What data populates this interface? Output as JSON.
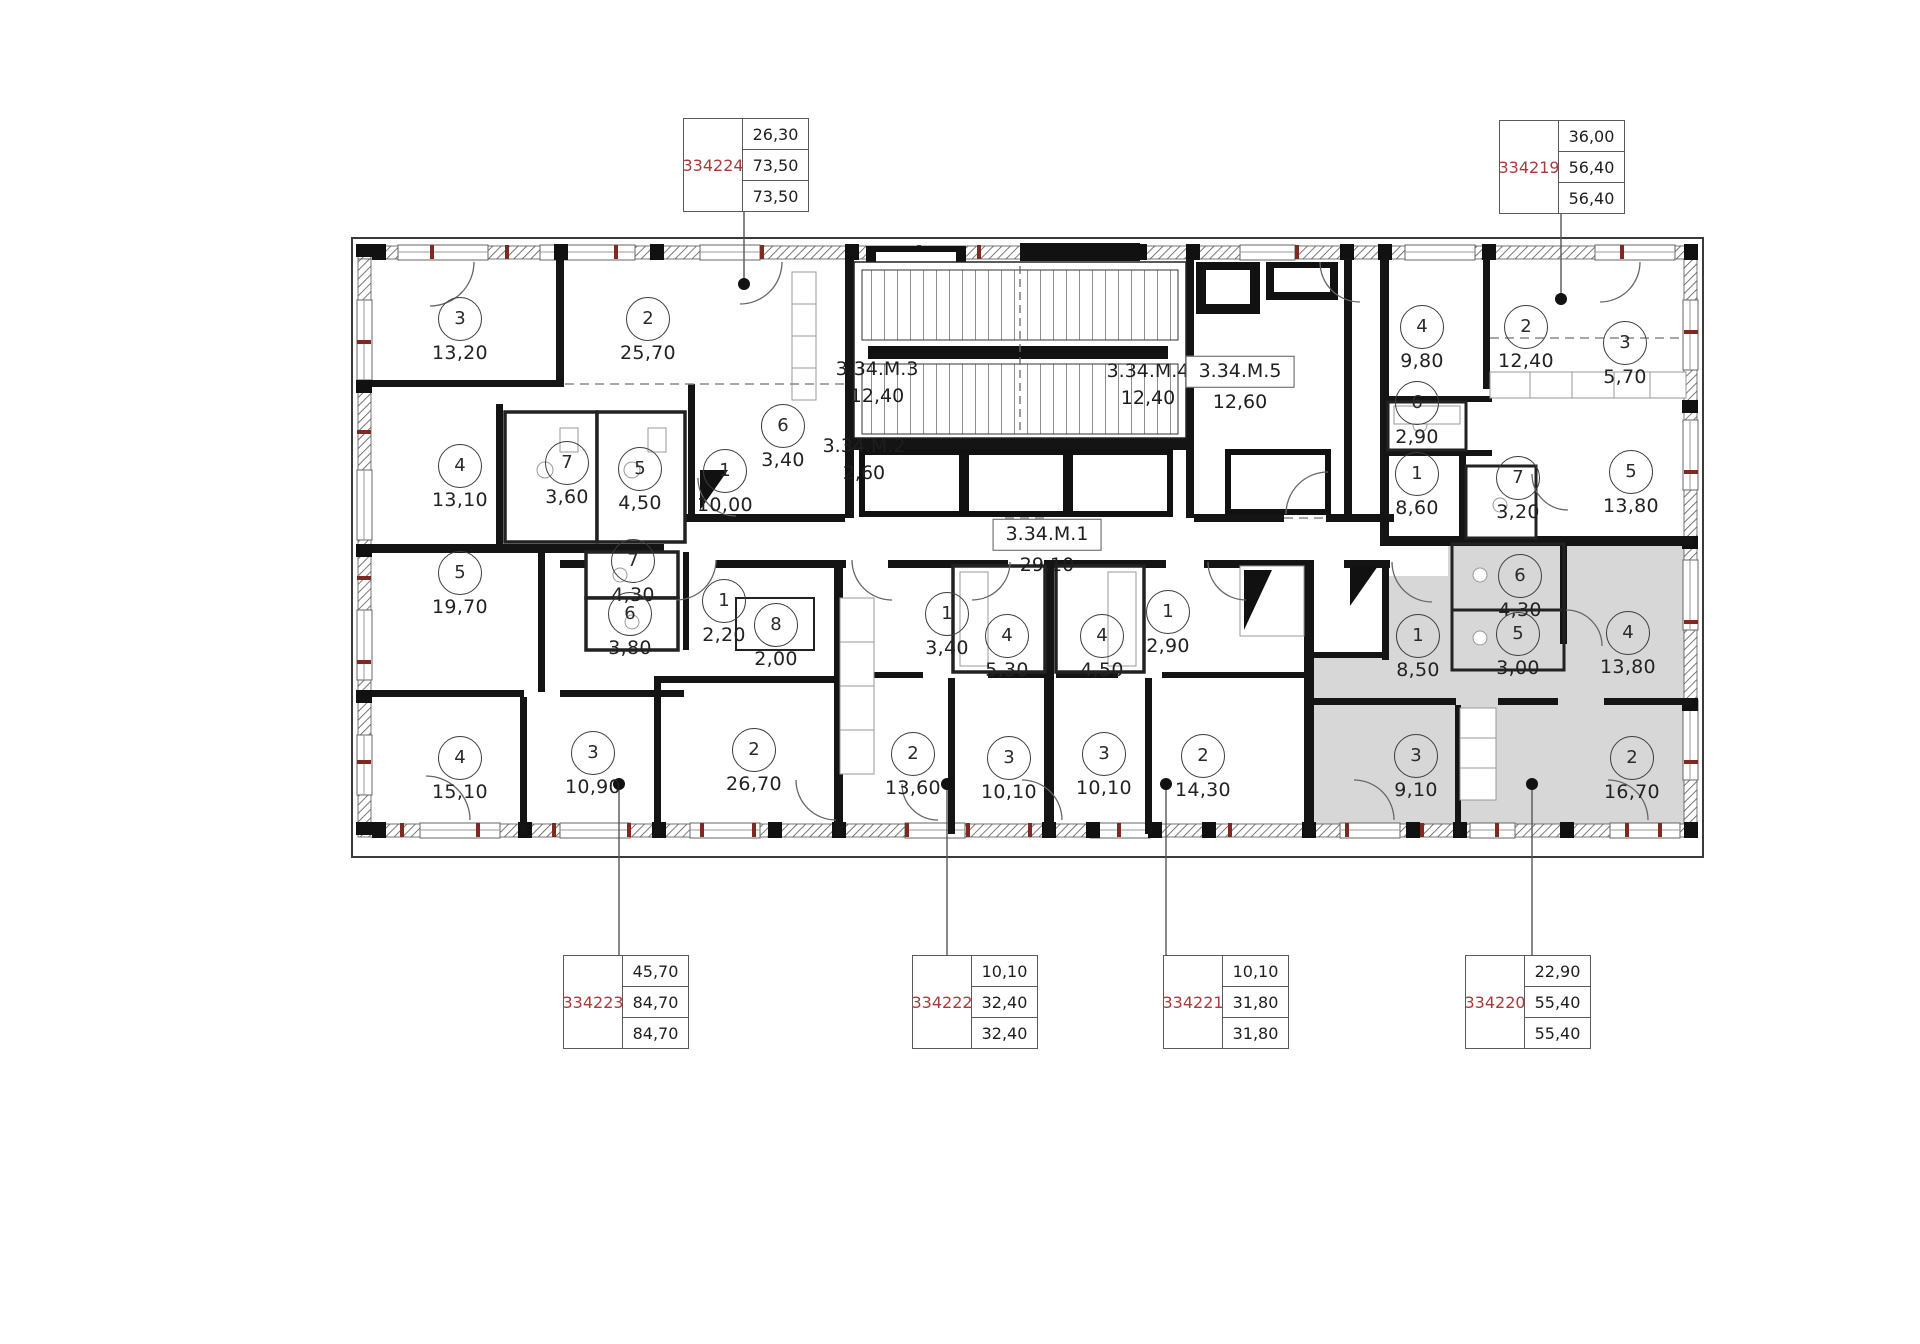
{
  "colors": {
    "highlight_fill": "#d7d7d7",
    "apartment_id_red": "#a93a3c",
    "wall_black": "#141414",
    "tick_dark_red": "#7e2a23"
  },
  "apartments": [
    {
      "id": "334224",
      "values": [
        "26,30",
        "73,50",
        "73,50"
      ],
      "box": {
        "x": 683,
        "y": 118
      },
      "dot": {
        "x": 744,
        "y": 284
      },
      "highlighted": false
    },
    {
      "id": "334219",
      "values": [
        "36,00",
        "56,40",
        "56,40"
      ],
      "box": {
        "x": 1499,
        "y": 120
      },
      "dot": {
        "x": 1561,
        "y": 299
      },
      "highlighted": false
    },
    {
      "id": "334223",
      "values": [
        "45,70",
        "84,70",
        "84,70"
      ],
      "box": {
        "x": 563,
        "y": 955
      },
      "dot": {
        "x": 619,
        "y": 784
      },
      "highlighted": false
    },
    {
      "id": "334222",
      "values": [
        "10,10",
        "32,40",
        "32,40"
      ],
      "box": {
        "x": 912,
        "y": 955
      },
      "dot": {
        "x": 947,
        "y": 784
      },
      "highlighted": false
    },
    {
      "id": "334221",
      "values": [
        "10,10",
        "31,80",
        "31,80"
      ],
      "box": {
        "x": 1163,
        "y": 955
      },
      "dot": {
        "x": 1166,
        "y": 784
      },
      "highlighted": false
    },
    {
      "id": "334220",
      "values": [
        "22,90",
        "55,40",
        "55,40"
      ],
      "box": {
        "x": 1465,
        "y": 955
      },
      "dot": {
        "x": 1532,
        "y": 784
      },
      "highlighted": true
    }
  ],
  "core_labels": [
    {
      "name": "3.34.M.1",
      "area": "29,10",
      "boxed": true,
      "x": 1047,
      "y": 548
    },
    {
      "name": "3.34.M.2",
      "area": "2,60",
      "boxed": false,
      "x": 864,
      "y": 460
    },
    {
      "name": "3.34.M.3",
      "area": "12,40",
      "boxed": false,
      "x": 877,
      "y": 383
    },
    {
      "name": "3.34.M.4",
      "area": "12,40",
      "boxed": false,
      "x": 1148,
      "y": 385
    },
    {
      "name": "3.34.M.5",
      "area": "12,60",
      "boxed": true,
      "x": 1240,
      "y": 385
    }
  ],
  "rooms": [
    {
      "apt": "334224",
      "n": "3",
      "area": "13,20",
      "x": 460,
      "y": 318
    },
    {
      "apt": "334224",
      "n": "2",
      "area": "25,70",
      "x": 648,
      "y": 318
    },
    {
      "apt": "334224",
      "n": "4",
      "area": "13,10",
      "x": 460,
      "y": 465
    },
    {
      "apt": "334224",
      "n": "7",
      "area": "3,60",
      "x": 567,
      "y": 462
    },
    {
      "apt": "334224",
      "n": "5",
      "area": "4,50",
      "x": 640,
      "y": 468
    },
    {
      "apt": "334224",
      "n": "6",
      "area": "3,40",
      "x": 783,
      "y": 425
    },
    {
      "apt": "334224",
      "n": "1",
      "area": "10,00",
      "x": 725,
      "y": 470
    },
    {
      "apt": "334223",
      "n": "5",
      "area": "19,70",
      "x": 460,
      "y": 572
    },
    {
      "apt": "334223",
      "n": "7",
      "area": "4,30",
      "x": 633,
      "y": 560
    },
    {
      "apt": "334223",
      "n": "6",
      "area": "3,80",
      "x": 630,
      "y": 613
    },
    {
      "apt": "334223",
      "n": "1",
      "area": "2,20",
      "x": 724,
      "y": 600
    },
    {
      "apt": "334223",
      "n": "8",
      "area": "2,00",
      "x": 776,
      "y": 624
    },
    {
      "apt": "334223",
      "n": "4",
      "area": "15,10",
      "x": 460,
      "y": 757
    },
    {
      "apt": "334223",
      "n": "3",
      "area": "10,90",
      "x": 593,
      "y": 752
    },
    {
      "apt": "334223",
      "n": "2",
      "area": "26,70",
      "x": 754,
      "y": 749
    },
    {
      "apt": "334222",
      "n": "1",
      "area": "3,40",
      "x": 947,
      "y": 613
    },
    {
      "apt": "334222",
      "n": "4",
      "area": "5,30",
      "x": 1007,
      "y": 635
    },
    {
      "apt": "334222",
      "n": "2",
      "area": "13,60",
      "x": 913,
      "y": 753
    },
    {
      "apt": "334222",
      "n": "3",
      "area": "10,10",
      "x": 1009,
      "y": 757
    },
    {
      "apt": "334221",
      "n": "4",
      "area": "4,50",
      "x": 1102,
      "y": 635
    },
    {
      "apt": "334221",
      "n": "1",
      "area": "2,90",
      "x": 1168,
      "y": 611
    },
    {
      "apt": "334221",
      "n": "3",
      "area": "10,10",
      "x": 1104,
      "y": 753
    },
    {
      "apt": "334221",
      "n": "2",
      "area": "14,30",
      "x": 1203,
      "y": 755
    },
    {
      "apt": "334219",
      "n": "4",
      "area": "9,80",
      "x": 1422,
      "y": 326
    },
    {
      "apt": "334219",
      "n": "2",
      "area": "12,40",
      "x": 1526,
      "y": 326
    },
    {
      "apt": "334219",
      "n": "3",
      "area": "5,70",
      "x": 1625,
      "y": 342
    },
    {
      "apt": "334219",
      "n": "6",
      "area": "2,90",
      "x": 1417,
      "y": 402
    },
    {
      "apt": "334219",
      "n": "1",
      "area": "8,60",
      "x": 1417,
      "y": 473
    },
    {
      "apt": "334219",
      "n": "7",
      "area": "3,20",
      "x": 1518,
      "y": 477
    },
    {
      "apt": "334219",
      "n": "5",
      "area": "13,80",
      "x": 1631,
      "y": 471
    },
    {
      "apt": "334220",
      "n": "6",
      "area": "4,30",
      "x": 1520,
      "y": 575
    },
    {
      "apt": "334220",
      "n": "1",
      "area": "8,50",
      "x": 1418,
      "y": 635
    },
    {
      "apt": "334220",
      "n": "5",
      "area": "3,00",
      "x": 1518,
      "y": 633
    },
    {
      "apt": "334220",
      "n": "4",
      "area": "13,80",
      "x": 1628,
      "y": 632
    },
    {
      "apt": "334220",
      "n": "3",
      "area": "9,10",
      "x": 1416,
      "y": 755
    },
    {
      "apt": "334220",
      "n": "2",
      "area": "16,70",
      "x": 1632,
      "y": 757
    }
  ]
}
